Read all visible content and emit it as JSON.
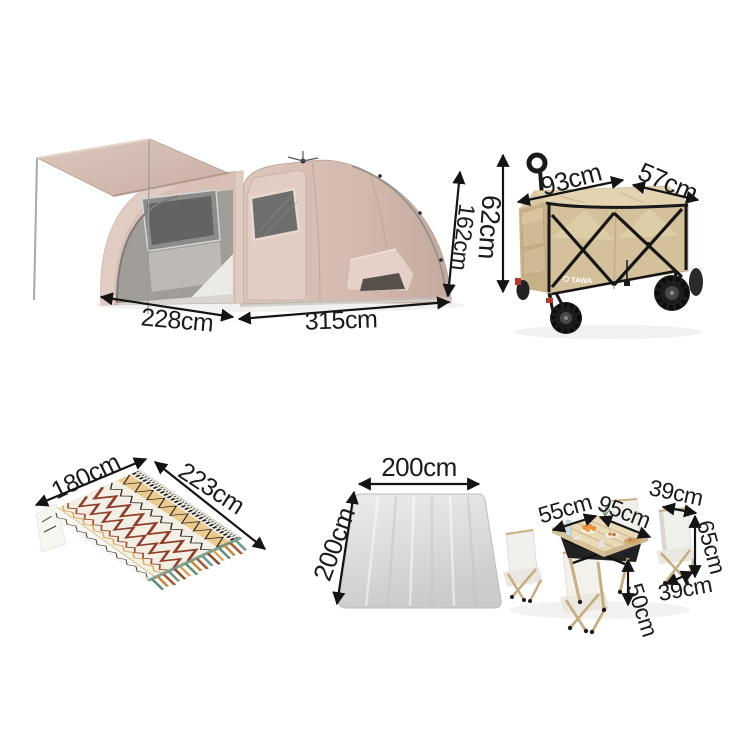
{
  "page": {
    "background": "#ffffff"
  },
  "products": {
    "tent": {
      "width_label": "228cm",
      "length_label": "315cm",
      "height_label": "162cm"
    },
    "wagon": {
      "brand": "TAWA",
      "length_label": "93cm",
      "depth_label": "57cm",
      "height_label": "62cm"
    },
    "blanket": {
      "width_label": "180cm",
      "length_label": "223cm"
    },
    "mat": {
      "width_label": "200cm",
      "depth_label": "200cm"
    },
    "table_set": {
      "table_width_label": "55cm",
      "table_length_label": "95cm",
      "chair_width_label": "39cm",
      "chair_height_label": "65cm",
      "table_height_label": "50cm",
      "chair_depth_label": "39cm"
    }
  },
  "colors": {
    "arrow": "#141414",
    "tent_fabric": "#d6beb4",
    "wagon_fabric": "#d4c19b",
    "wagon_frame": "#1c1c1c",
    "blanket_base": "#f3efe5",
    "blanket_accent": "#8e3e2b",
    "mat_gray": "#d9d9d9",
    "table_top": "#e7d7b4",
    "chair_fabric": "#f2f0ea",
    "chair_frame": "#c9ad82"
  }
}
